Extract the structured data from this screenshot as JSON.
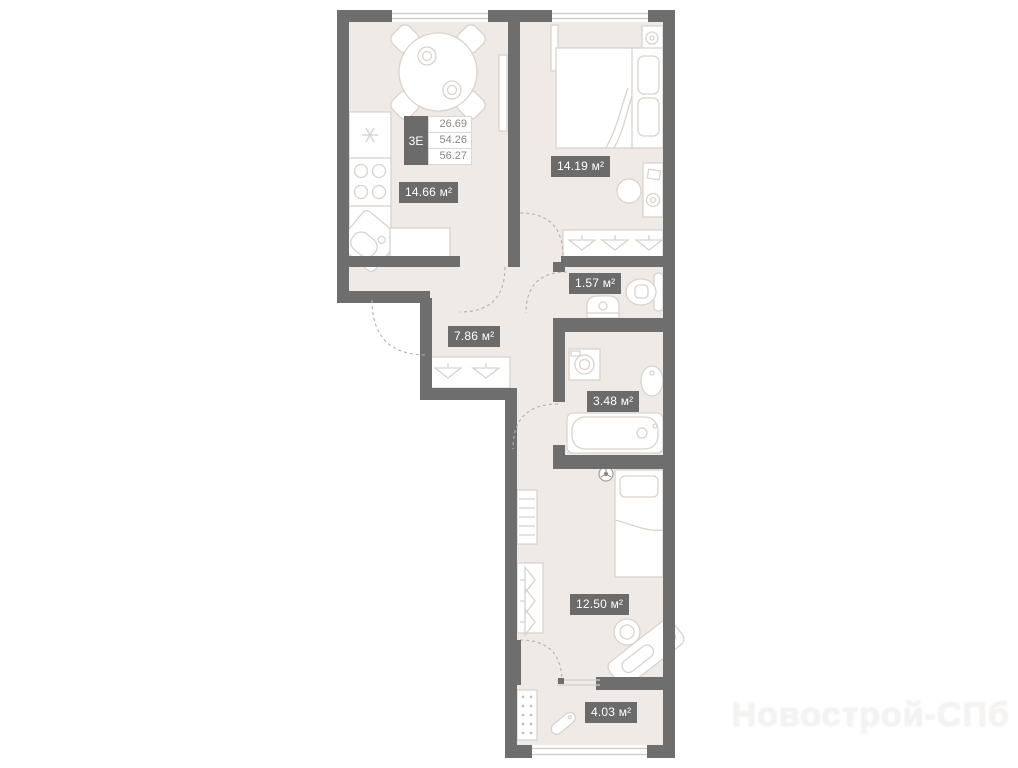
{
  "floor_plan": {
    "unit_card": {
      "type": "3Е",
      "areas": [
        "26.69",
        "54.26",
        "56.27"
      ]
    },
    "rooms": [
      {
        "name": "kitchen-living-room",
        "area": "14.66 м²"
      },
      {
        "name": "bedroom-1",
        "area": "14.19 м²"
      },
      {
        "name": "wc",
        "area": "1.57 м²"
      },
      {
        "name": "hallway",
        "area": "7.86 м²"
      },
      {
        "name": "bathroom",
        "area": "3.48 м²"
      },
      {
        "name": "bedroom-2",
        "area": "12.50 м²"
      },
      {
        "name": "entry-hall",
        "area": "4.03 м²"
      }
    ],
    "watermark": "Новострой-СПб",
    "colors": {
      "wall": "#6e6e6e",
      "room_fill": "#efeae6",
      "furniture_stroke": "#d9d3ce",
      "label_bg": "#6b6b6b",
      "label_text": "#ffffff",
      "window_line": "#cfc9c5",
      "door_arc": "#b5afab"
    }
  }
}
